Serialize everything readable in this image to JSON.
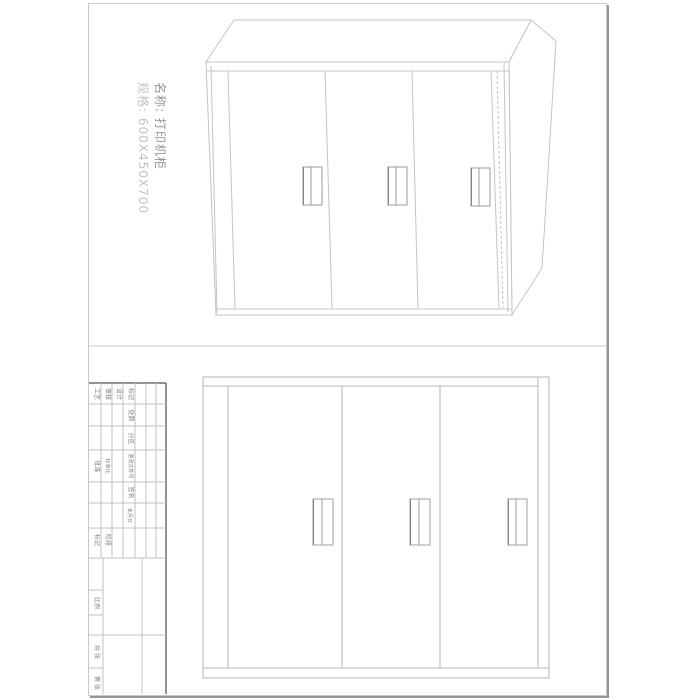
{
  "annotation": {
    "name_label": "名称: 打印机柜",
    "spec_label": "规格: 600X450X700"
  },
  "title_block": {
    "row_labels": {
      "gongyi": "工艺",
      "shenhe": "审核",
      "sheji": "设计"
    },
    "header": {
      "biaoji": "标记",
      "chushu": "处数",
      "fenqu": "分区",
      "genggai": "更改文件号",
      "qianming": "签名",
      "nianyueri": "年月日"
    },
    "mid": {
      "pizhun": "批准",
      "biaozhunhua": "标准化",
      "jieduanbiaoji": "阶段标记",
      "bili": "比例"
    },
    "bottom": {
      "gongzhang": "共 张",
      "dizhang": "第 张"
    }
  },
  "cabinet": {
    "door_count": 3,
    "views": [
      "perspective",
      "front"
    ]
  },
  "colors": {
    "sheet_border": "#c9c9c9",
    "sheet_shadow": "#949494",
    "frame_dark": "#6e6e6e",
    "line_light": "#c4c4c8",
    "line_mid": "#b5b5b5",
    "handle_line": "#9a9a9a",
    "name_text": "#949494",
    "spec_text": "#c3c3c3",
    "titleblock_text": "#7c7c7c"
  }
}
